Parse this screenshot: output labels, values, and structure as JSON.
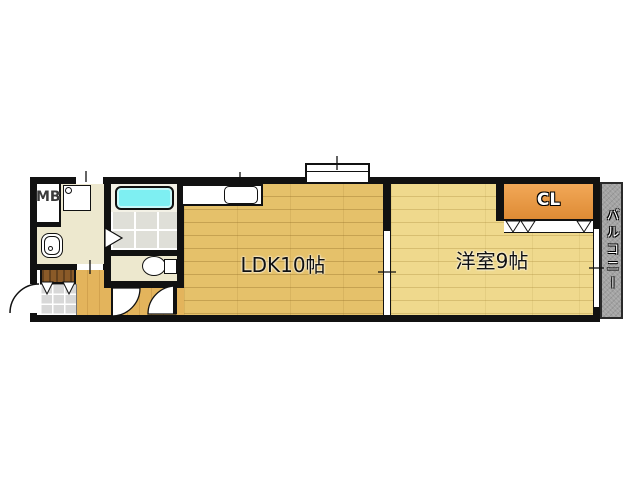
{
  "floorplan": {
    "labels": {
      "meter_box": "MB",
      "ldk": "LDK10帖",
      "western_room": "洋室9帖",
      "closet": "CL",
      "balcony": "バルコニー"
    },
    "colors": {
      "wall": "#111111",
      "ldk_floor": "#E5C16A",
      "western_floor": "#EFD98D",
      "corridor_floor": "#E3B45C",
      "sanitary_floor": "#EDE8CE",
      "bath_tile": "#DFDFD8",
      "bathtub": "#7EEFF2",
      "closet_top": "#F2A858",
      "closet_bottom": "#DE8B35",
      "balcony": "#A3A3A3",
      "entrance_tile": "#D8D8D8",
      "shoe_cabinet": "#8A5A28"
    }
  }
}
